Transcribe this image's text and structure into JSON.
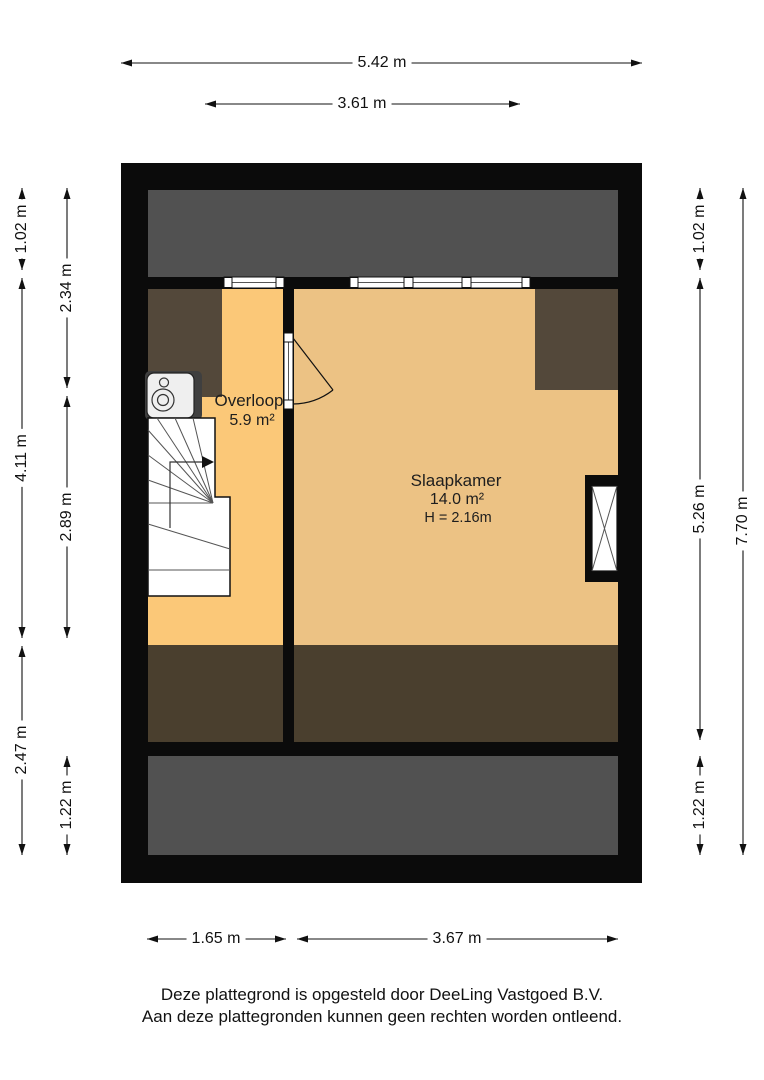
{
  "plan": {
    "rooms": {
      "overloop": {
        "name": "Overloop",
        "area": "5.9 m²"
      },
      "slaapkamer": {
        "name": "Slaapkamer",
        "area": "14.0 m²",
        "ceiling_height": "H = 2.16m"
      }
    },
    "dimensions": {
      "top_total": "5.42 m",
      "top_inner": "3.61 m",
      "bottom_left": "1.65 m",
      "bottom_right": "3.67 m",
      "left_outer_top": "1.02 m",
      "left_outer_mid": "4.11 m",
      "left_outer_bottom": "2.47 m",
      "left_inner_top": "2.34 m",
      "left_inner_mid": "2.89 m",
      "left_inner_bottom": "1.22 m",
      "right_inner_top": "1.02 m",
      "right_inner_mid": "5.26 m",
      "right_inner_bottom": "1.22 m",
      "right_outer_total": "7.70 m"
    },
    "colors": {
      "wall": "#0b0b0b",
      "roof_void": "#515151",
      "low_headroom_top": "#53483a",
      "low_headroom_bottom": "#4a3f2e",
      "floor_overloop": "#fbc878",
      "floor_slaapkamer": "#ecc284"
    }
  },
  "footer": {
    "line1": "Deze plattegrond is opgesteld door DeeLing Vastgoed B.V.",
    "line2": "Aan deze plattegronden kunnen geen rechten worden ontleend."
  }
}
